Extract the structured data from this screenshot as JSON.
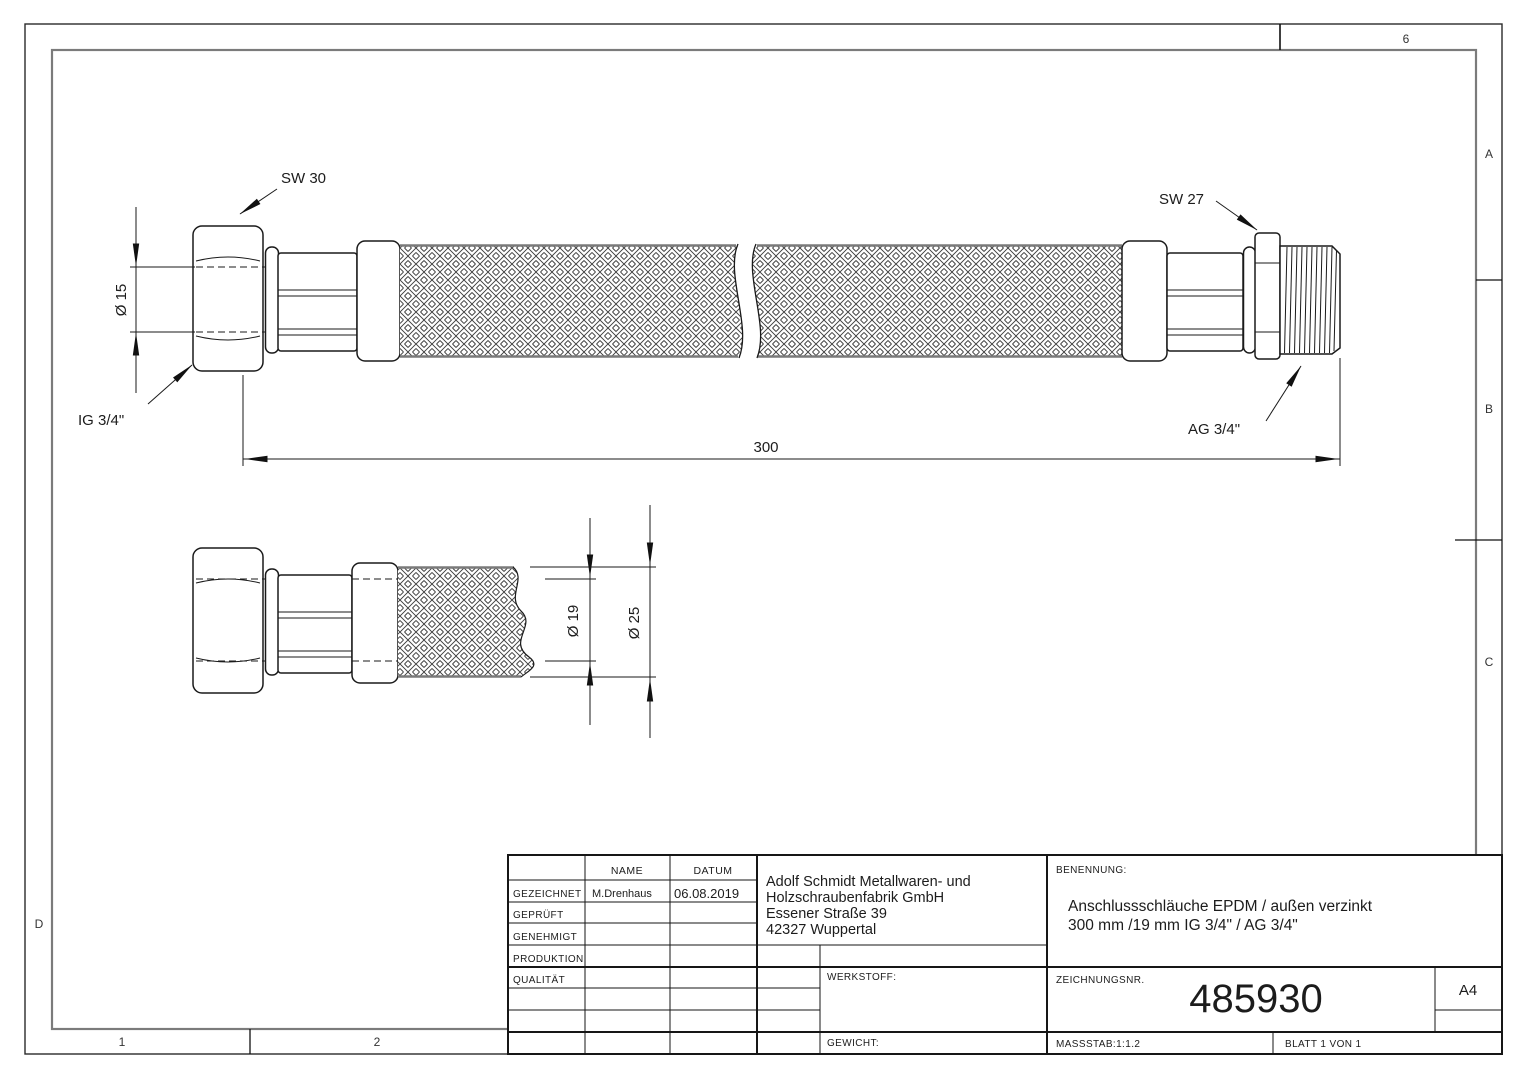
{
  "zones": {
    "top_6": "6",
    "right_a": "A",
    "right_b": "B",
    "right_c": "C",
    "left_d": "D",
    "bottom_1": "1",
    "bottom_2": "2"
  },
  "dimensions": {
    "sw30": "SW 30",
    "sw27": "SW 27",
    "ig": "IG 3/4\"",
    "ag": "AG 3/4\"",
    "dia15": "Ø 15",
    "length": "300",
    "dia19": "Ø 19",
    "dia25": "Ø 25"
  },
  "title_block": {
    "headers": {
      "name": "NAME",
      "date": "DATUM"
    },
    "approvals": [
      {
        "label": "GEZEICHNET",
        "name": "M.Drenhaus",
        "date": "06.08.2019"
      },
      {
        "label": "GEPRÜFT",
        "name": "",
        "date": ""
      },
      {
        "label": "GENEHMIGT",
        "name": "",
        "date": ""
      },
      {
        "label": "PRODUKTION",
        "name": "",
        "date": ""
      },
      {
        "label": "QUALITÄT",
        "name": "",
        "date": ""
      }
    ],
    "company": [
      "Adolf Schmidt Metallwaren- und",
      "Holzschraubenfabrik GmbH",
      "Essener Straße 39",
      "42327 Wuppertal"
    ],
    "benennung_label": "BENENNUNG:",
    "benennung_line1": "Anschlussschläuche EPDM / außen verzinkt",
    "benennung_line2": "300 mm /19 mm IG 3/4\" / AG 3/4\"",
    "werkstoff_label": "WERKSTOFF:",
    "gewicht_label": "GEWICHT:",
    "zeichnungsnr_label": "ZEICHNUNGSNR.",
    "zeichnungsnr": "485930",
    "format": "A4",
    "massstab": "MASSSTAB:1:1.2",
    "blatt": "BLATT 1 VON 1"
  }
}
